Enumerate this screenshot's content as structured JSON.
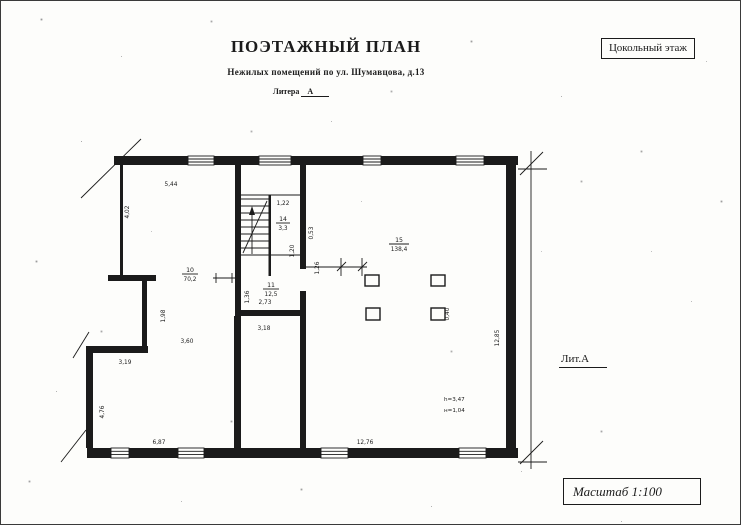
{
  "header": {
    "title": "ПОЭТАЖНЫЙ ПЛАН",
    "subtitle": "Нежилых помещений по ул. Шумавцова, д.13",
    "litera_label": "Литера",
    "litera_value": "А",
    "floor_badge": "Цокольный этаж"
  },
  "side": {
    "lit_label": "Лит.А"
  },
  "footer": {
    "scale_label": "Масштаб 1:100"
  },
  "plan": {
    "rooms": {
      "r10": {
        "number": "10",
        "area": "70,2"
      },
      "r11": {
        "number": "11",
        "area": "12,5"
      },
      "r14": {
        "number": "14",
        "area": "3,3"
      },
      "r15": {
        "number": "15",
        "area": "138,4"
      }
    },
    "dims": {
      "top_left_width": "5,44",
      "left_upper_height": "4,02",
      "stair_top_width": "1,22",
      "stair_pier": "0,53",
      "stair_inner": "1,20",
      "stair_opening": "1,26",
      "room11_left": "1,36",
      "room11_width": "2,73",
      "corridor_width": "3,18",
      "left_mid_height": "1,98",
      "room10_width": "3,60",
      "step_width": "3,19",
      "left_lower_height": "4,76",
      "bottom_left_width": "6,87",
      "bottom_right_width": "12,76",
      "right_height": "12,85",
      "column_size": "0,40",
      "ceiling_height": "h=3,47",
      "depth_note": "н=1,04"
    }
  }
}
